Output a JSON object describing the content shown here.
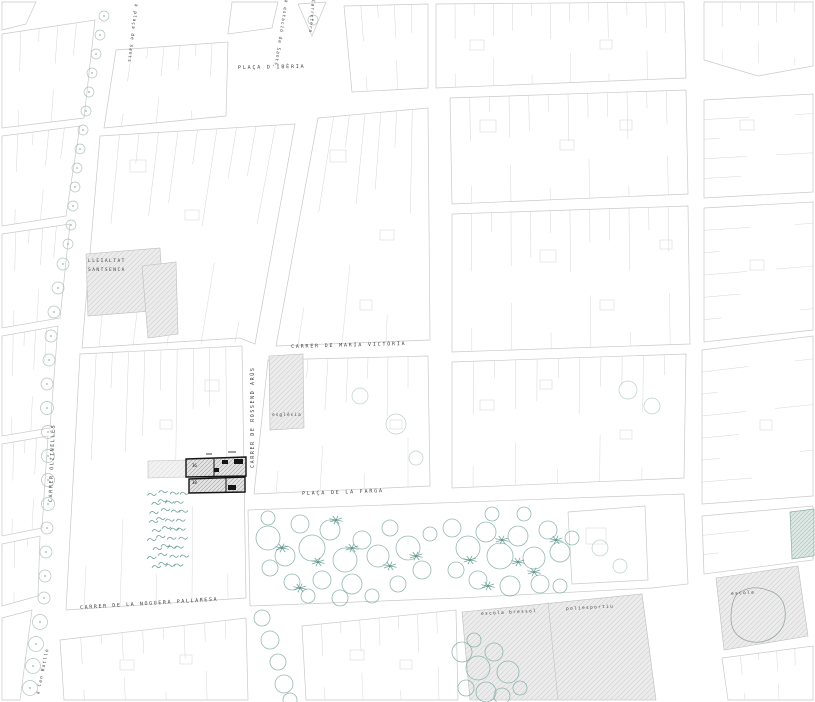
{
  "map": {
    "streets": {
      "placa_iberia": "PLAÇA D'IBÈRIA",
      "maria_victoria": "CARRER DE MARIA VICTÒRIA",
      "rossend_arus": "CARRER DE ROSSEND ARÚS",
      "olzinelles": "CARRER OLZINELLES",
      "placa_farga": "PLAÇA DE LA FARGA",
      "noguera_pallaresa": "CARRER DE LA NOGUERA PALLARESA"
    },
    "directions": {
      "placa_de_sants": "a plaça de Sants",
      "estacio_de_sants": "a estació de Sants",
      "carretera": "Carretera",
      "can_batllo": "a Can Batlló"
    },
    "buildings": {
      "lleialtat_line1": "LLEIALTAT",
      "lleialtat_line2": "SANTSENCA",
      "esglesia": "església",
      "escola_bressol": "escola bressol",
      "poliesportiu": "poliesportiu",
      "escola": "escola"
    },
    "site": {
      "number_top": "36",
      "number_bottom": "38"
    },
    "colors": {
      "line": "#c9c9c9",
      "label": "#3d3d3d",
      "vegetation": "#7da69d",
      "site_outline": "#141414",
      "shaded_fill": "#ebebeb"
    }
  }
}
